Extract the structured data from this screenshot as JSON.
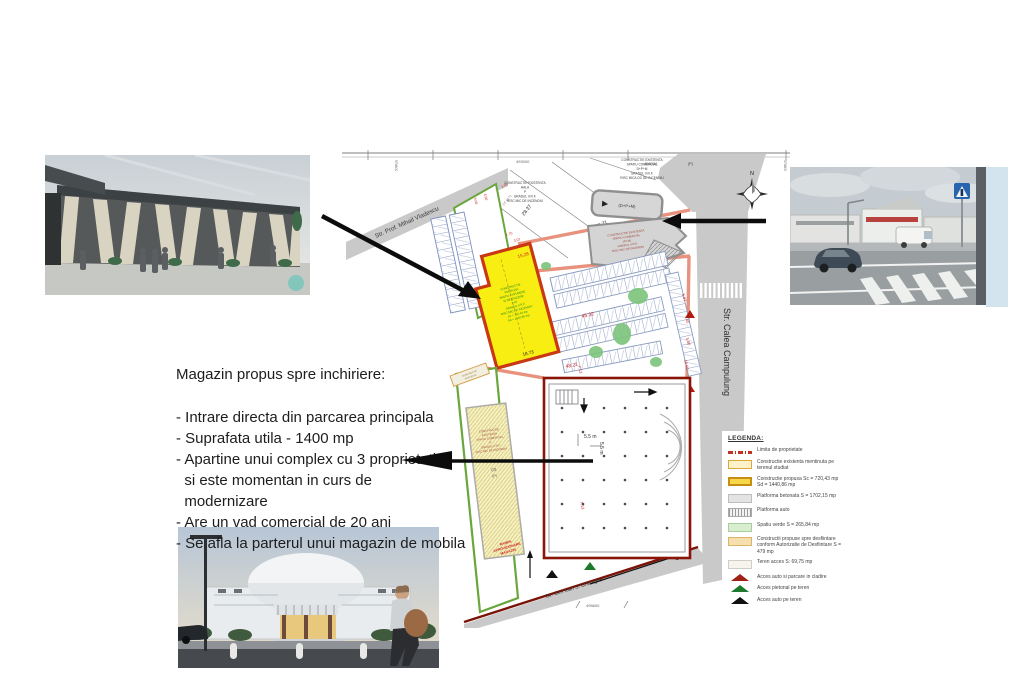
{
  "annotation": {
    "title": "Magazin propus spre inchiriere:",
    "lines": [
      "- Intrare directa din parcarea principala",
      "- Suprafata utila - 1400 mp",
      "- Apartine unui complex cu 3 proprietati",
      "  si este momentan in curs de",
      "  modernizare",
      "- Are un vad comercial de 20 ani",
      "- Se afla la parterul unui magazin de mobila"
    ]
  },
  "plan": {
    "streets": {
      "vladescu": "Str. Prof. Mihail Vladescu",
      "campulung": "Str. Calea Campulung",
      "gheorghe": "Str. Gen Ioan S. Gheorghe"
    },
    "grid": {
      "top_left": "493000",
      "top_right": "493000",
      "side_left": "574600",
      "side_right": "574800",
      "bottom": "495600"
    },
    "north_label": "N",
    "buildings": {
      "comercial_top": [
        "CONSTRUCTIE EXISTENTA",
        "SPATIU COMERCIAL",
        "D+P+M",
        "GRADUL II R.F.",
        "RISC MIC/LOC DE INCENDIU"
      ],
      "hala": [
        "CONSTRUCTIE EXISTENTA",
        "HALA",
        "P",
        "GRADUL II R.F.",
        "RISC MIC DE INCENDIU"
      ],
      "dpm_label": "(D+P+M)",
      "p_label": "(P)",
      "comercial_mid": [
        "CONSTRUCTIE EXISTENTA",
        "SPATIU COMERCIAL",
        "(P+M)",
        "GRADUL II R.F.",
        "RISC MIC DE INCENDIU"
      ],
      "propusa": [
        "CONSTRUCTIE",
        "PROPUSA",
        "SPATIU EXPUNERE",
        "SI DESFACERE",
        "P+E",
        "GRADUL II R.F.",
        "RISC MIC DE INCENDIU",
        "Sc = 720.43 mp",
        "Sd = 1440.86 mp"
      ],
      "existenta_left": [
        "CONSTRUCTIE",
        "EXISTENTA",
        "SPATIU COMERCIAL",
        "P",
        "GRADUL II R.F.",
        "RISC MIC DE INCENDIU"
      ],
      "c8": "C8",
      "c8_p": "(P)",
      "c7": "C7",
      "c7_p": "(P)",
      "rampa": [
        "RAMPA",
        "APROVIZIONARE",
        "MAGAZIN"
      ],
      "cf": "CF 6171"
    },
    "dim_labels": [
      "28.37",
      "36.71",
      "27.5",
      "45.32",
      "48.21",
      "15.28",
      "3.07",
      "1.70",
      "10.29",
      "18.73",
      "7.13",
      "5.07",
      "7.45",
      "5.00",
      "10.60",
      "5.00",
      "6.00",
      "2.05",
      "5.5 m",
      "5.5 m"
    ]
  },
  "legend": {
    "title": "LEGENDA:",
    "items": [
      {
        "label": "Limita de proprietate"
      },
      {
        "label": "Constructie existenta mentinuta pe terenul studiat"
      },
      {
        "label": "Constructie propusa Sc = 720,43 mp Sd = 1440,86 mp"
      },
      {
        "label": "Platforma betonata S = 1702,15 mp"
      },
      {
        "label": "Platforma auto"
      },
      {
        "label": "Spatiu verde S = 265,84 mp"
      },
      {
        "label": "Constructii propuse spre desfiintare conform Autorizatie de Desfiintare S = 479 mp"
      },
      {
        "label": "Teren acces S: 69,75 mp"
      },
      {
        "label": "Acces auto si parcare in cladire"
      },
      {
        "label": "Acces pietonal pe teren"
      },
      {
        "label": "Acces auto pe teren"
      }
    ]
  },
  "colors": {
    "road_gray": "#c9c9c9",
    "parcel_yellow": "#f8ee12",
    "parcel_border": "#c93812",
    "boundary_red": "#8b1408",
    "green_limit": "#69a63c",
    "salmon_road": "#e8917c"
  }
}
